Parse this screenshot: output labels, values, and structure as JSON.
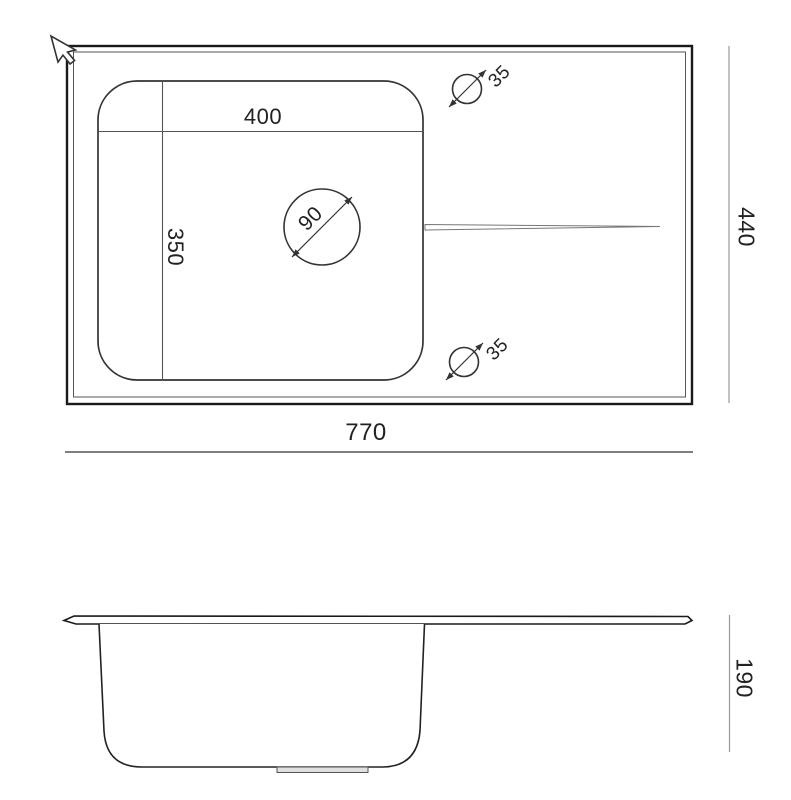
{
  "drawing": {
    "type": "sink technical drawing",
    "views": {
      "top_view": "plan view of sink with drainboard",
      "side_view": "front profile of sink bowl"
    }
  },
  "dimensions": {
    "overall_width": "770",
    "overall_depth": "440",
    "bowl_width": "400",
    "bowl_depth": "350",
    "drain_hole_diameter": "90",
    "tap_hole_top_diameter": "35",
    "tap_hole_bottom_diameter": "35",
    "bowl_height": "190"
  },
  "colors": {
    "outline": "#1a1a1a",
    "secondary_line": "#555555",
    "dimension_line": "#888888",
    "text": "#222222",
    "background": "#ffffff"
  }
}
